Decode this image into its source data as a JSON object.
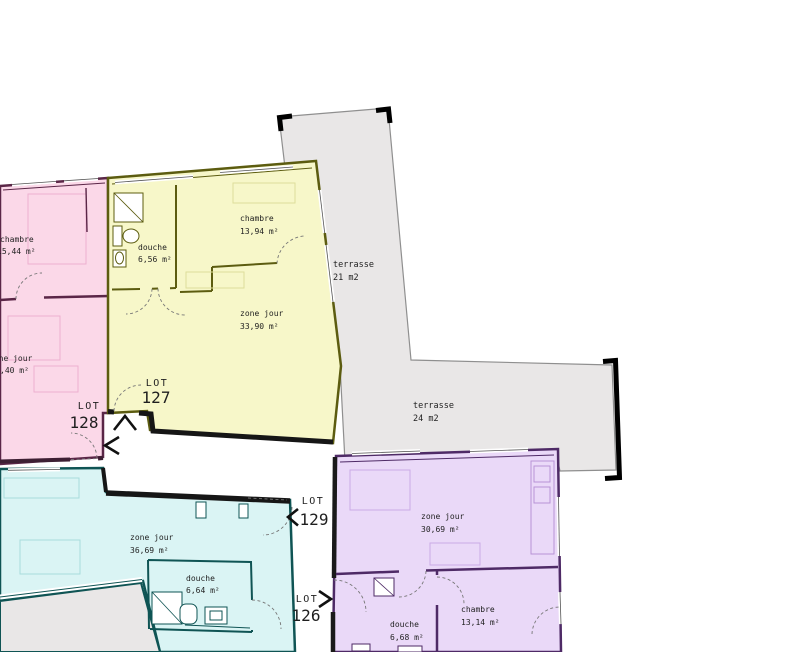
{
  "canvas": {
    "width": 800,
    "height": 652,
    "background": "#ffffff"
  },
  "colors": {
    "lot128_fill": "#fbd8e8",
    "lot128_wall": "#5a2647",
    "lot127_fill": "#f7f7c9",
    "lot127_wall": "#5c5c10",
    "lot129_fill": "#daf4f4",
    "lot129_wall": "#0f5454",
    "lot126_fill": "#ead9f8",
    "lot126_wall": "#4e2a66",
    "terrace_fill": "#e9e7e7",
    "terrace_outline": "#8f8f8f",
    "corridor_wall": "#1a1a1a",
    "text": "#1f1f1f"
  },
  "units": {
    "lot127": {
      "lot_label": "LOT",
      "lot_number": "127",
      "rooms": {
        "chambre": {
          "name": "chambre",
          "area": "13,94 m²"
        },
        "douche": {
          "name": "douche",
          "area": "6,56 m²"
        },
        "zone_jour": {
          "name": "zone jour",
          "area": "33,90 m²"
        }
      }
    },
    "lot128": {
      "lot_label": "LOT",
      "lot_number": "128",
      "rooms": {
        "chambre": {
          "name": "chambre",
          "area": "15,44 m²"
        },
        "zone_jour": {
          "name": "zone jour",
          "area": ",40 m²"
        }
      }
    },
    "lot129": {
      "lot_label": "LOT",
      "lot_number": "129",
      "rooms": {
        "zone_jour": {
          "name": "zone jour",
          "area": "36,69 m²"
        },
        "douche": {
          "name": "douche",
          "area": "6,64 m²"
        }
      }
    },
    "lot126": {
      "lot_label": "LOT",
      "lot_number": "126",
      "rooms": {
        "zone_jour": {
          "name": "zone jour",
          "area": "30,69 m²"
        },
        "douche": {
          "name": "douche",
          "area": "6,68 m²"
        },
        "chambre": {
          "name": "chambre",
          "area": "13,14 m²"
        }
      }
    }
  },
  "terraces": [
    {
      "name": "terrasse",
      "area": "21 m2"
    },
    {
      "name": "terrasse",
      "area": "24 m2"
    }
  ]
}
